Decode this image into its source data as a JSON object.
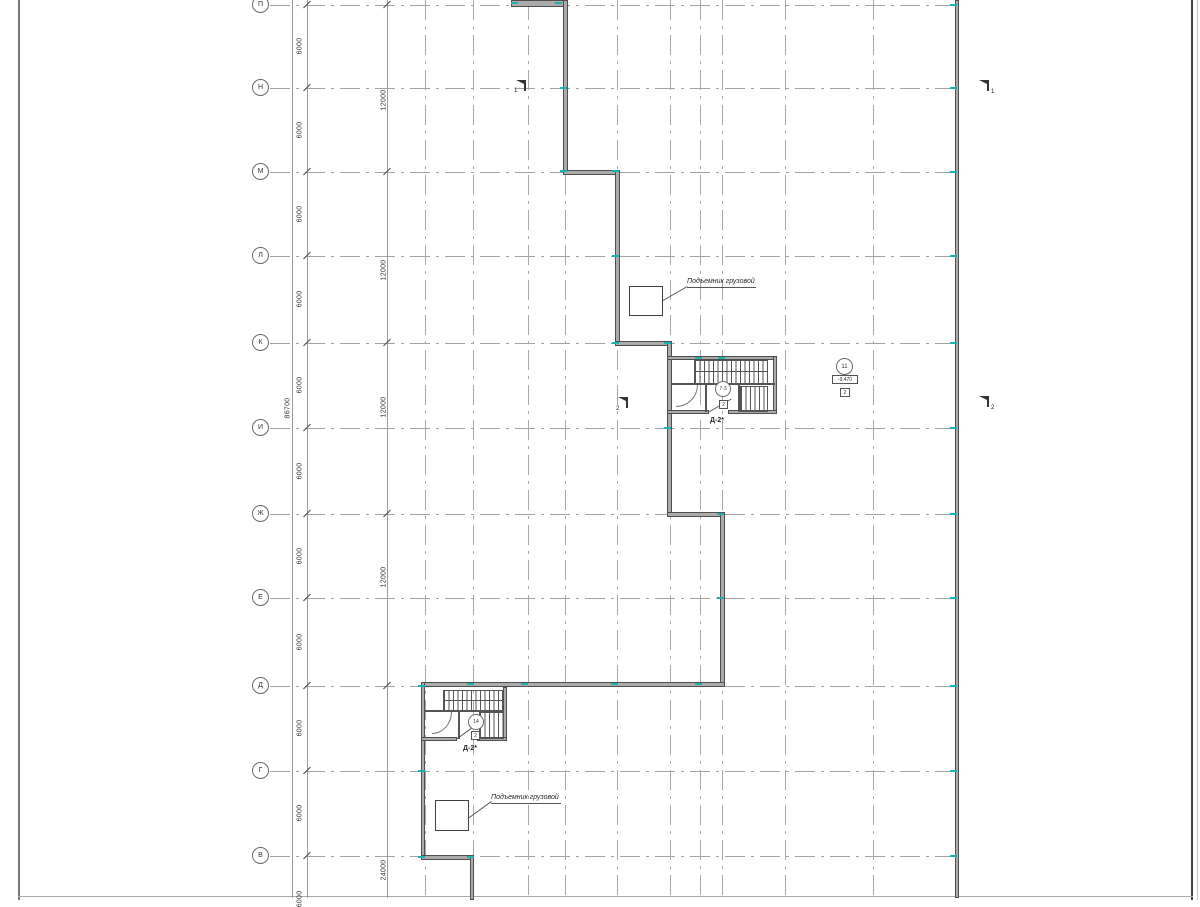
{
  "sheet": {
    "rows": [
      {
        "label": "П"
      },
      {
        "label": "Н"
      },
      {
        "label": "М"
      },
      {
        "label": "Л"
      },
      {
        "label": "К"
      },
      {
        "label": "И"
      },
      {
        "label": "Ж"
      },
      {
        "label": "Е"
      },
      {
        "label": "Д"
      },
      {
        "label": "Г"
      },
      {
        "label": "В"
      }
    ],
    "dimensions": {
      "bay": "6000",
      "double_bay": "12000",
      "quad_bay": "24000",
      "total": "86700"
    },
    "labels": {
      "hoist": "Подъемник грузовой",
      "stair_mark": "Д-2*",
      "stair_node_upper": "7-3",
      "stair_node_lower": "14",
      "node_square": "2",
      "detail_bubble": "11",
      "elevation": "-9.470",
      "section_mark_1": "1",
      "section_mark_2": "2"
    },
    "colors": {
      "wall": "#ababab",
      "wall_edge": "#4f4f4f",
      "grid": "#a3a3a3",
      "teal": "#1ab2b2"
    }
  }
}
